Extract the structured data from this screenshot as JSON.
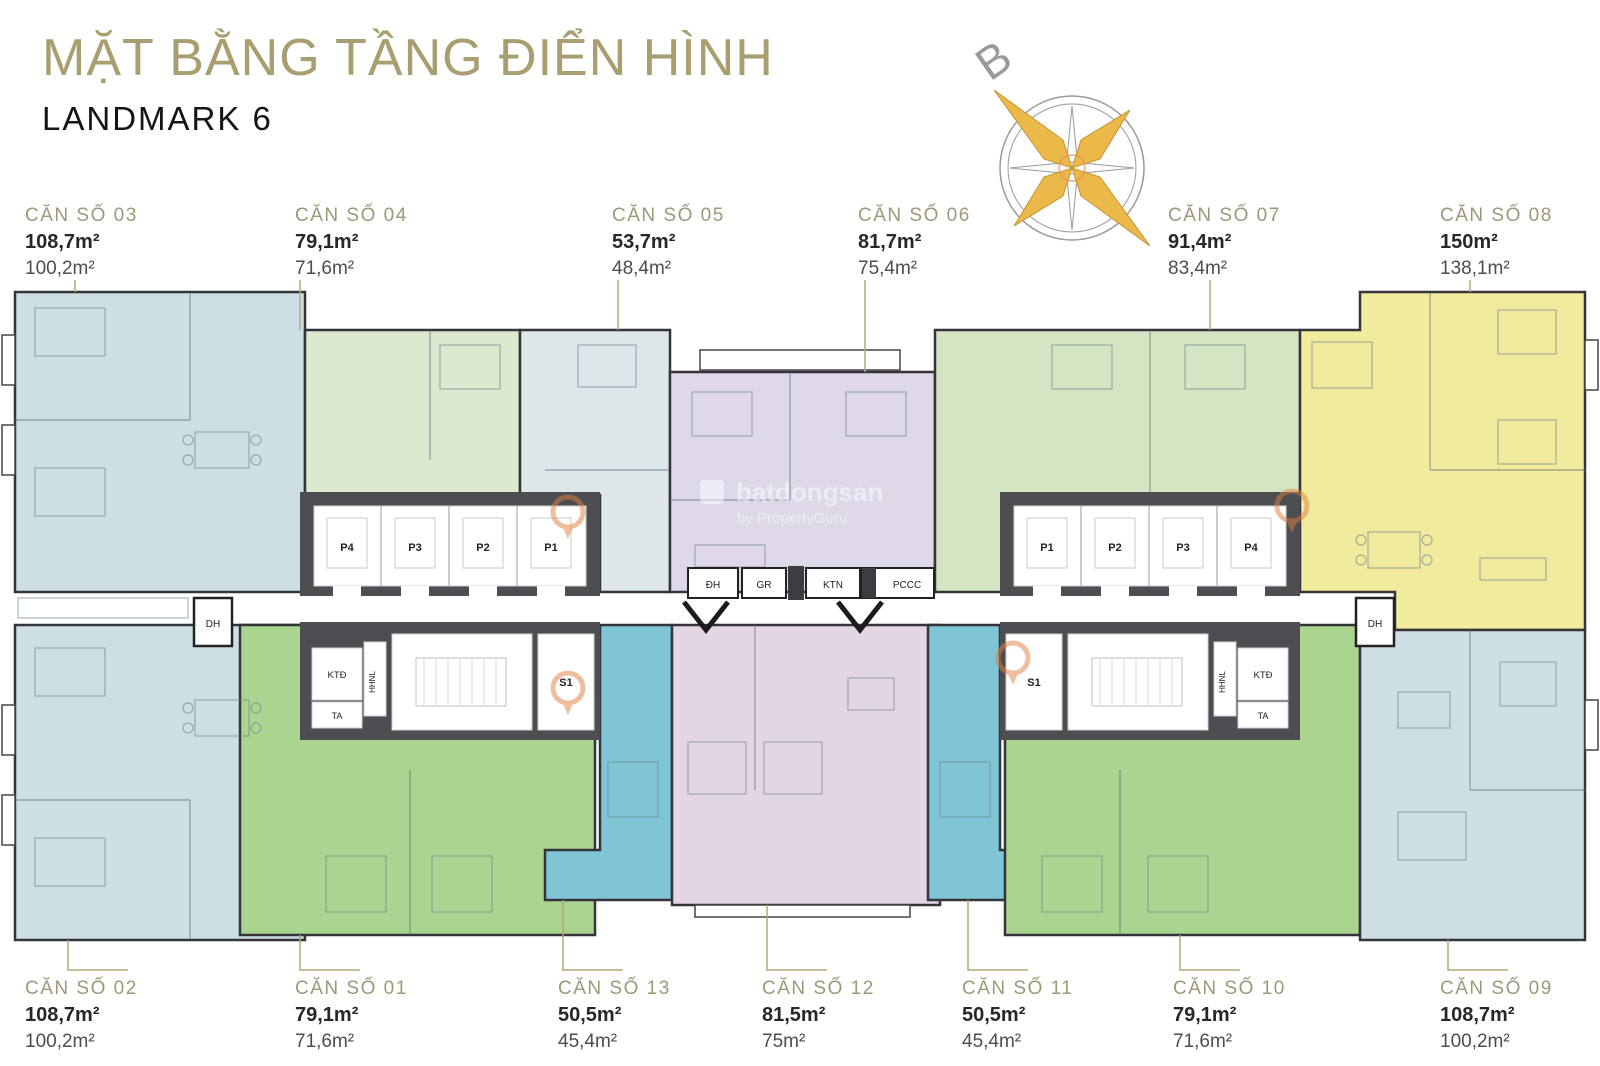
{
  "header": {
    "title": "MẶT BẰNG TẦNG ĐIỂN HÌNH",
    "subtitle": "LANDMARK 6"
  },
  "compass": {
    "north_label": "B"
  },
  "watermark": {
    "brand": "batdongsan",
    "byline": "by PropertyGuru"
  },
  "units": {
    "top": [
      {
        "label": "CĂN SỐ 03",
        "area_construction": "108,7m²",
        "area_carpet": "100,2m²",
        "color": "#cddfe5"
      },
      {
        "label": "CĂN SỐ 04",
        "area_construction": "79,1m²",
        "area_carpet": "71,6m²",
        "color": "#dde9cf"
      },
      {
        "label": "CĂN SỐ 05",
        "area_construction": "53,7m²",
        "area_carpet": "48,4m²",
        "color": "#dde6e9"
      },
      {
        "label": "CĂN SỐ 06",
        "area_construction": "81,7m²",
        "area_carpet": "75,4m²",
        "color": "#ded8e9"
      },
      {
        "label": "CĂN SỐ 07",
        "area_construction": "91,4m²",
        "area_carpet": "83,4m²",
        "color": "#d5e5c3"
      },
      {
        "label": "CĂN SỐ 08",
        "area_construction": "150m²",
        "area_carpet": "138,1m²",
        "color": "#f1eb9e"
      }
    ],
    "bottom": [
      {
        "label": "CĂN SỐ 02",
        "area_construction": "108,7m²",
        "area_carpet": "100,2m²",
        "color": "#cddfe5"
      },
      {
        "label": "CĂN SỐ 01",
        "area_construction": "79,1m²",
        "area_carpet": "71,6m²",
        "color": "#abd491"
      },
      {
        "label": "CĂN SỐ 13",
        "area_construction": "50,5m²",
        "area_carpet": "45,4m²",
        "color": "#7fc5d5"
      },
      {
        "label": "CĂN SỐ 12",
        "area_construction": "81,5m²",
        "area_carpet": "75m²",
        "color": "#e3d5e4"
      },
      {
        "label": "CĂN SỐ 11",
        "area_construction": "50,5m²",
        "area_carpet": "45,4m²",
        "color": "#7fc5d5"
      },
      {
        "label": "CĂN SỐ 10",
        "area_construction": "79,1m²",
        "area_carpet": "71,6m²",
        "color": "#abd491"
      },
      {
        "label": "CĂN SỐ 09",
        "area_construction": "108,7m²",
        "area_carpet": "100,2m²",
        "color": "#cddfe5"
      }
    ]
  },
  "core": {
    "left_elevators": [
      "P4",
      "P3",
      "P2",
      "P1"
    ],
    "right_elevators": [
      "P1",
      "P2",
      "P3",
      "P4"
    ],
    "stair_label": "S1",
    "corridor_rooms": [
      "ĐH",
      "GR",
      "KTN",
      "PCCC"
    ],
    "tech_rooms": {
      "ktd": "KTĐ",
      "hhnl": "HHNL",
      "ta": "TA"
    },
    "edge_room": "DH"
  }
}
